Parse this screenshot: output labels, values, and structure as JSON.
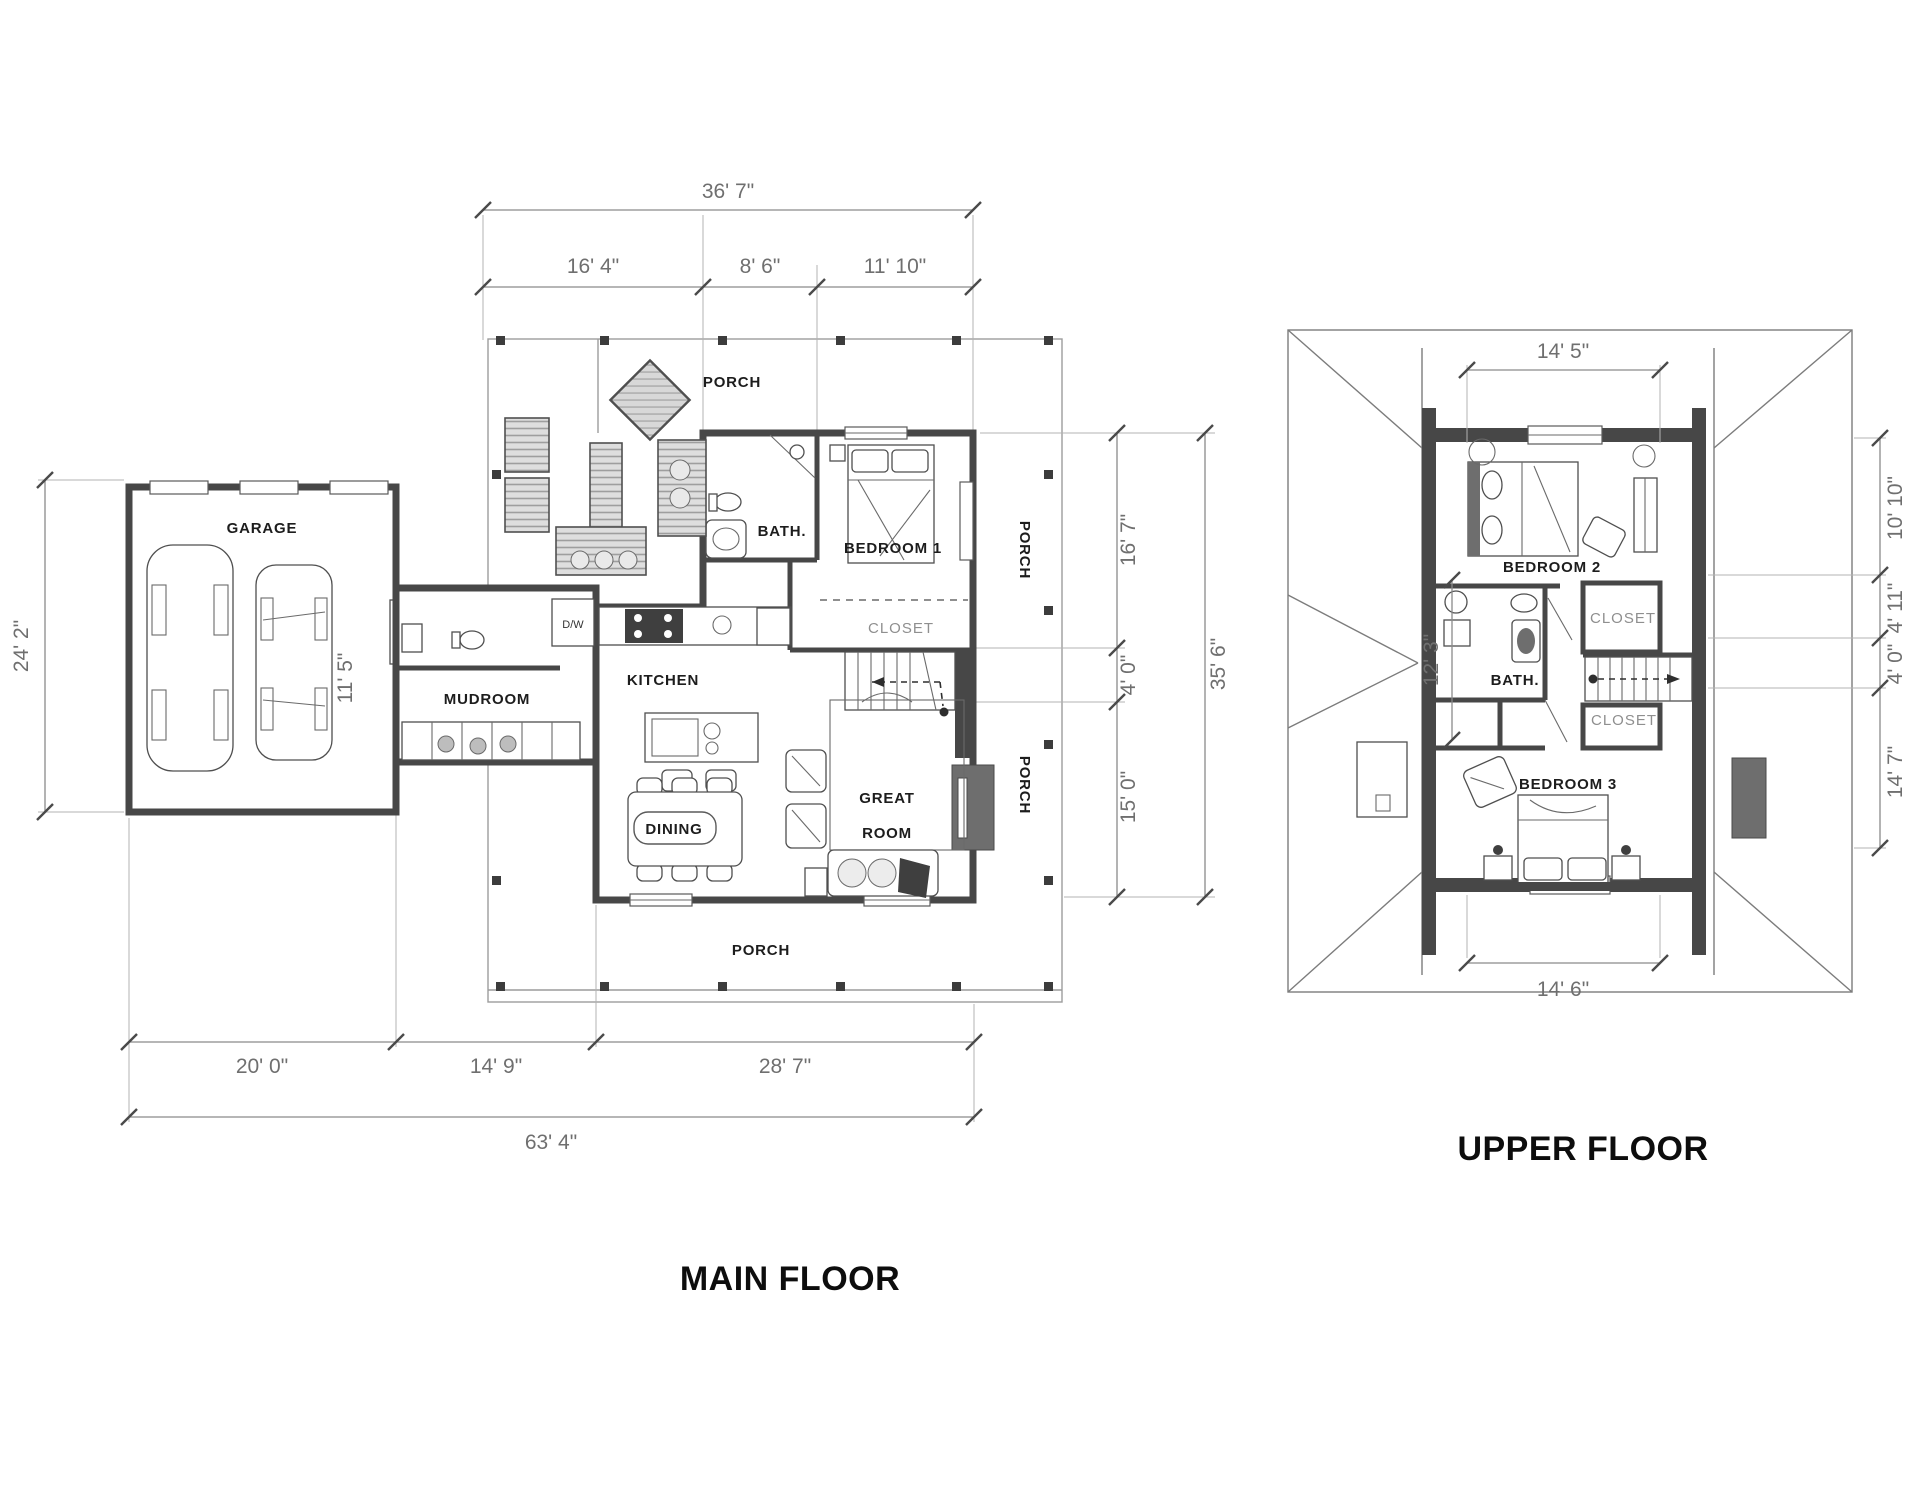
{
  "colors": {
    "wall": "#474747",
    "dim_line": "#8a8a8a",
    "dim_text": "#6f6f6f",
    "room_text": "#1d1d1d",
    "dark_fill": "#6e6e6e",
    "background": "#ffffff"
  },
  "main_floor": {
    "title": "MAIN FLOOR",
    "rooms": {
      "garage": "GARAGE",
      "porch_top": "PORCH",
      "bath": "BATH.",
      "bedroom1": "BEDROOM 1",
      "closet": "CLOSET",
      "kitchen": "KITCHEN",
      "mudroom": "MUDROOM",
      "dining": "DINING",
      "great_room_line1": "GREAT",
      "great_room_line2": "ROOM",
      "porch_right_upper": "PORCH",
      "porch_right_lower": "PORCH",
      "porch_bottom": "PORCH",
      "dishwasher": "D/W"
    },
    "dims": {
      "top_total": "36' 7\"",
      "top_seg_1": "16' 4\"",
      "top_seg_2": "8' 6\"",
      "top_seg_3": "11' 10\"",
      "right_seg_1": "16' 7\"",
      "right_seg_2": "4' 0\"",
      "right_seg_3": "15' 0\"",
      "right_total": "35' 6\"",
      "left_total": "24' 2\"",
      "garage_depth": "11' 5\"",
      "bottom_seg_1": "20' 0\"",
      "bottom_seg_2": "14' 9\"",
      "bottom_seg_3": "28' 7\"",
      "bottom_total": "63' 4\""
    }
  },
  "upper_floor": {
    "title": "UPPER FLOOR",
    "rooms": {
      "bedroom2": "BEDROOM 2",
      "bath": "BATH.",
      "closet_upper": "CLOSET",
      "closet_lower": "CLOSET",
      "bedroom3": "BEDROOM 3"
    },
    "dims": {
      "top": "14' 5\"",
      "bottom": "14' 6\"",
      "left": "12' 3\"",
      "right_seg_1": "10' 10\"",
      "right_seg_2": "4' 11\"",
      "right_seg_3": "4' 0\"",
      "right_seg_4": "14' 7\""
    }
  }
}
